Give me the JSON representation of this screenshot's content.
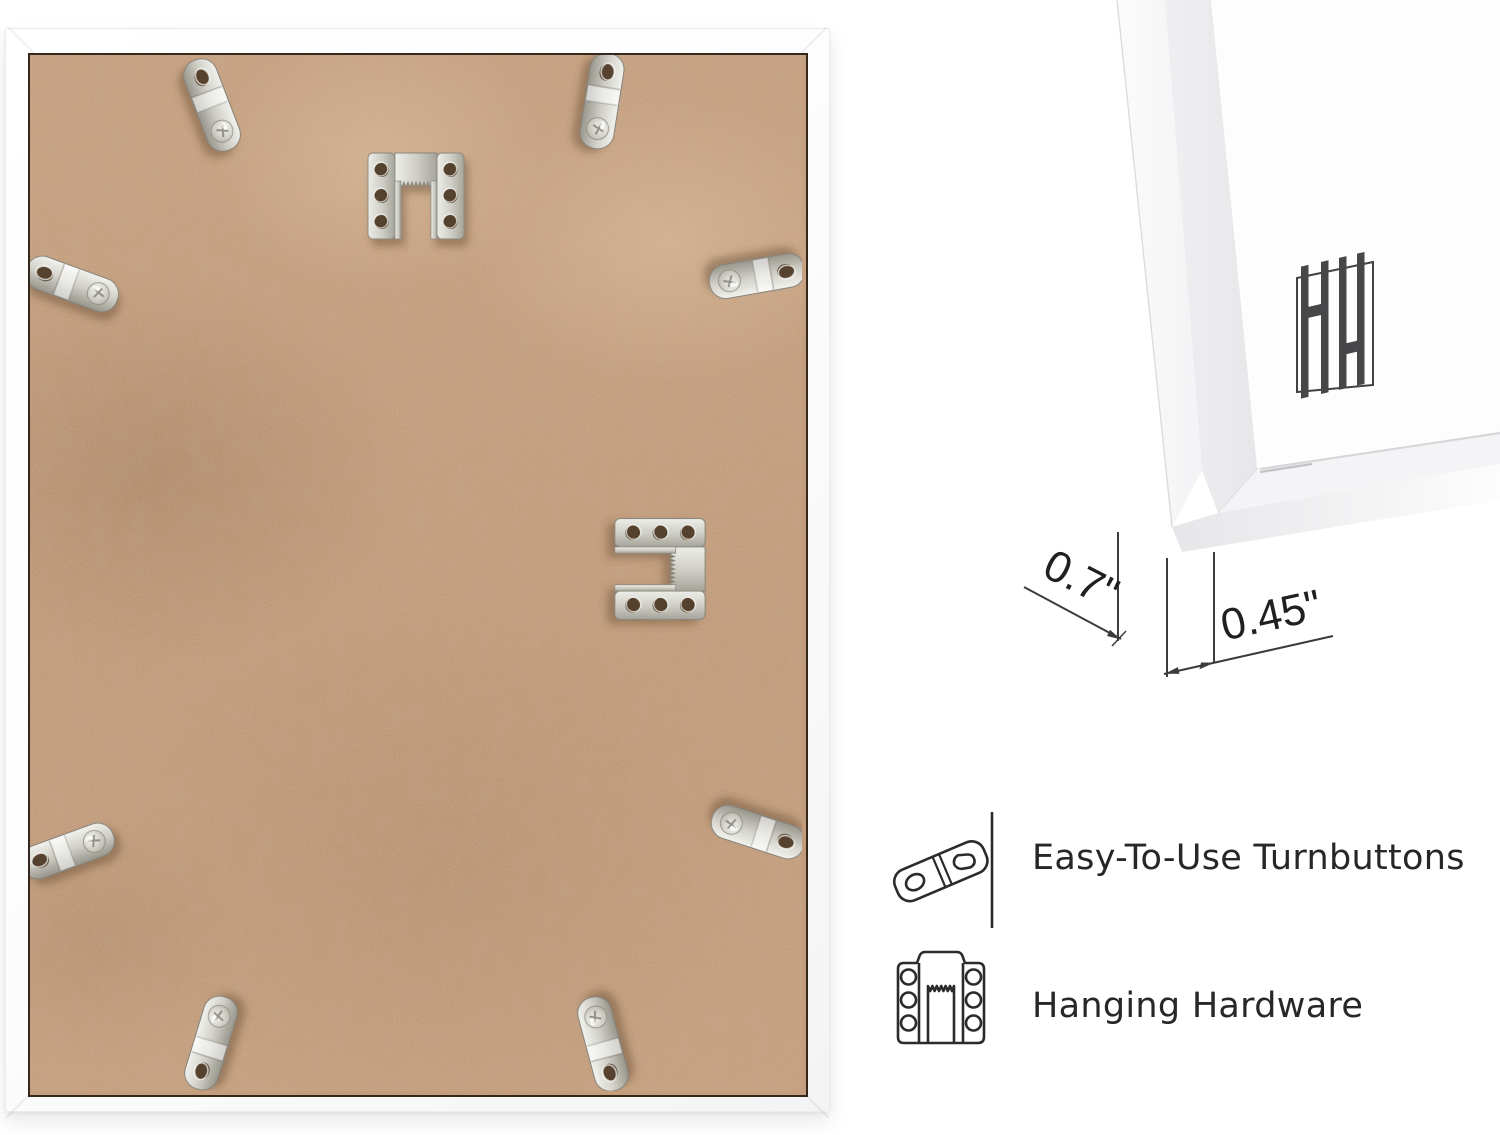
{
  "dimensions": {
    "frame_depth": "0.7\"",
    "frame_face_width": "0.45\""
  },
  "features": [
    {
      "icon": "turnbutton-icon",
      "label": "Easy-To-Use Turnbuttons"
    },
    {
      "icon": "sawtooth-hanger-icon",
      "label": "Hanging Hardware"
    }
  ],
  "brand": {
    "monogram": "HH",
    "icon": "hh-monogram-logo"
  },
  "photo": {
    "subject": "frame-back-with-hardware",
    "hardware": {
      "turnbutton_count": 8,
      "sawtooth_hanger_count": 2
    }
  },
  "colors": {
    "page_background": "#ffffff",
    "board_tan": "#c39c7b",
    "board_gap_line": "#34281c",
    "frame_white": "#fdfdfd",
    "metal_silver": "#c9c8c0",
    "annotation_line": "#3c3c3c",
    "text_dark": "#272727",
    "logo_gray": "#474749"
  }
}
